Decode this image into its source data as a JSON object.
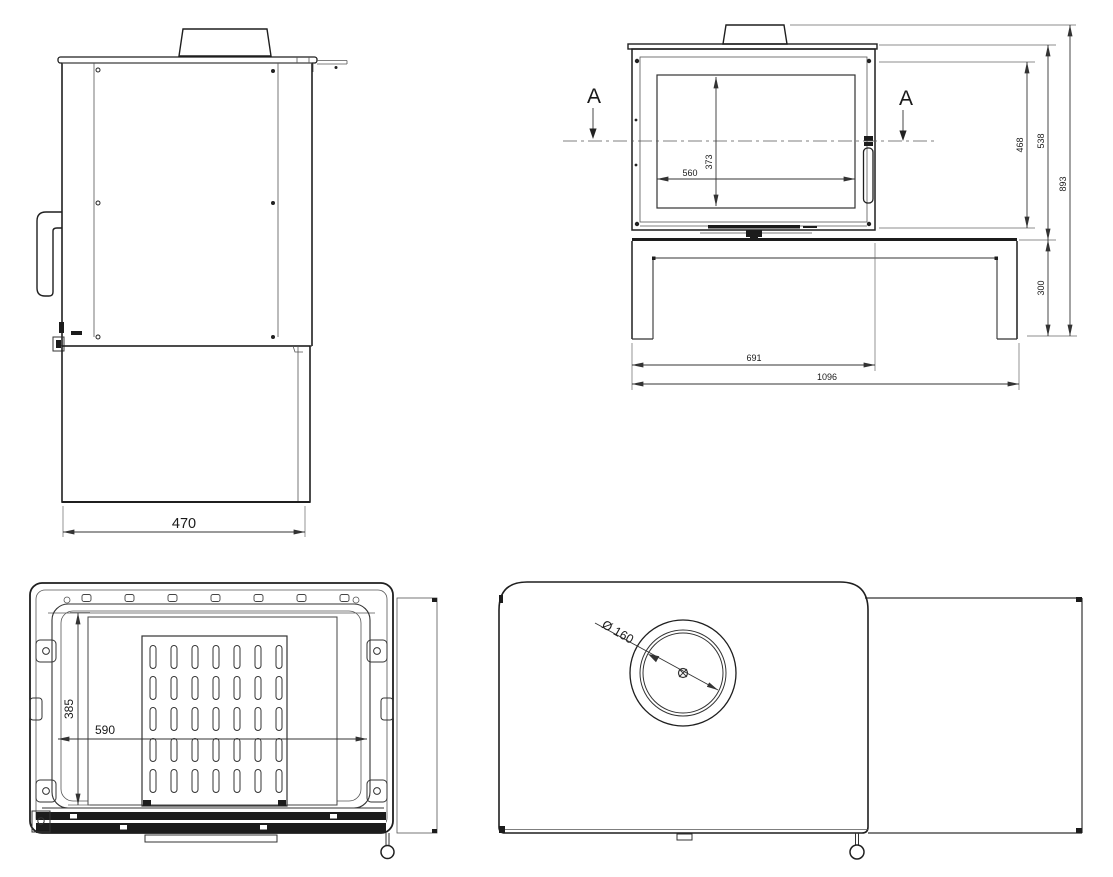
{
  "drawing": {
    "type": "stove-technical-drawing",
    "colors": {
      "background": "#ffffff",
      "line": "#1f1f1f",
      "dimension": "#333333"
    },
    "views": {
      "side": {
        "dim_depth": "470"
      },
      "front": {
        "section_label_left": "A",
        "section_label_right": "A",
        "dim_glass_width": "560",
        "dim_glass_height": "373",
        "dim_firebox_height": "468",
        "dim_body_height": "538",
        "dim_overall_height": "893",
        "dim_plinth_height": "300",
        "dim_body_width": "691",
        "dim_overall_width": "1096"
      },
      "firebox": {
        "dim_opening_height": "385",
        "dim_opening_width": "590"
      },
      "top": {
        "dim_flue_diameter": "Ø 160"
      }
    }
  }
}
